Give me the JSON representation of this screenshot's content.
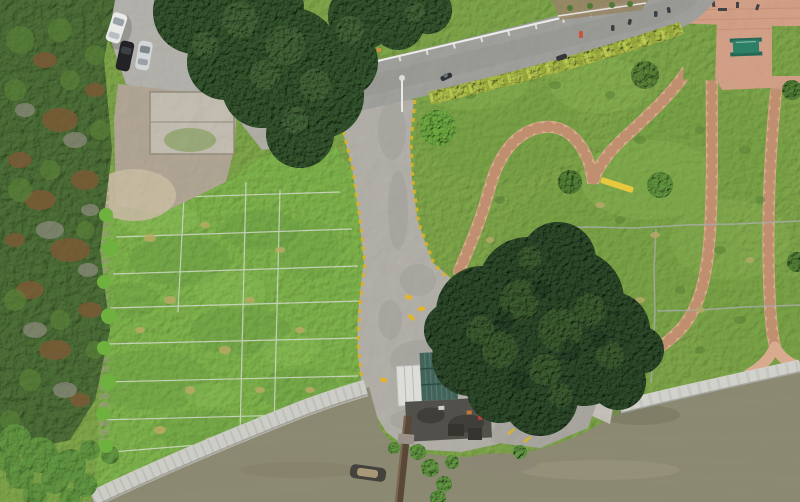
{
  "scene": {
    "type": "aerial-drone-photo",
    "subject": "riverside park with lawns, stone paths, road, seawall and boat pier",
    "view": "top-down"
  },
  "palette": {
    "grass_park": "#7da449",
    "grass_lawn": "#7db14b",
    "lawn_shade": "#649441",
    "forest_dark": "#4a6b35",
    "foliage_brown": "#7e5a36",
    "foliage_gray": "#8f8c80",
    "shrub_green": "#5f9240",
    "tree_dark": "#31502b",
    "tree_highlight": "#47683a",
    "central_tree_dark": "#2b4628",
    "central_tree_highlight": "#3f6030",
    "road_asphalt": "#a2a29e",
    "concrete": "#b6b4ae",
    "access_road": "#b4b2ab",
    "dirt": "#b3a896",
    "sand": "#cbbfa4",
    "path_pink": "#d9ab8e",
    "path_edge": "#c08f70",
    "plaza_pink": "#d6a389",
    "hedge_green": "#a6b647",
    "curb_yellow": "#d8b02e",
    "water_olive": "#908d76",
    "seawall_gray": "#cdcdc7",
    "ramp_gray": "#c6c4bc",
    "pier_brown": "#5a4836",
    "boat_hull": "#44423c",
    "boat_cover": "#a89878",
    "roof_green": "#41635a",
    "shed_white": "#dcdcd8",
    "building_dark": "#52504a",
    "car_white": "#e9e9e7",
    "car_black": "#232326",
    "car_silver": "#d3d6d8",
    "bench_yellow": "#e8c93e",
    "table_green": "#2e7f68",
    "sapling_green": "#6fb13f",
    "sod_grid_line": "#d8dcd4",
    "guardrail_white": "#ececea",
    "pipe_gray": "#a6aca6",
    "person_dark": "#3a3e42",
    "person_red": "#c9543a"
  },
  "objects": {
    "parked_cars": [
      "white car",
      "black car",
      "silver car"
    ],
    "road_users": [
      "scooter with rider",
      "parked motorcycle",
      "pedestrian in red",
      "5 dark pedestrians"
    ],
    "structures": [
      "green ribbed boathouse roof",
      "white shed",
      "dark flat-roof building",
      "picnic table",
      "yellow bench",
      "lamp post"
    ],
    "waterfront": [
      "riprap seawall",
      "concrete seawall",
      "boat ramp",
      "wooden pier",
      "moored boat"
    ],
    "landscape": [
      "sod lawn with white string grid",
      "row of 8 saplings",
      "heart shaped stone path",
      "pink paver paths",
      "hedge along road",
      "plaza pavement"
    ]
  }
}
